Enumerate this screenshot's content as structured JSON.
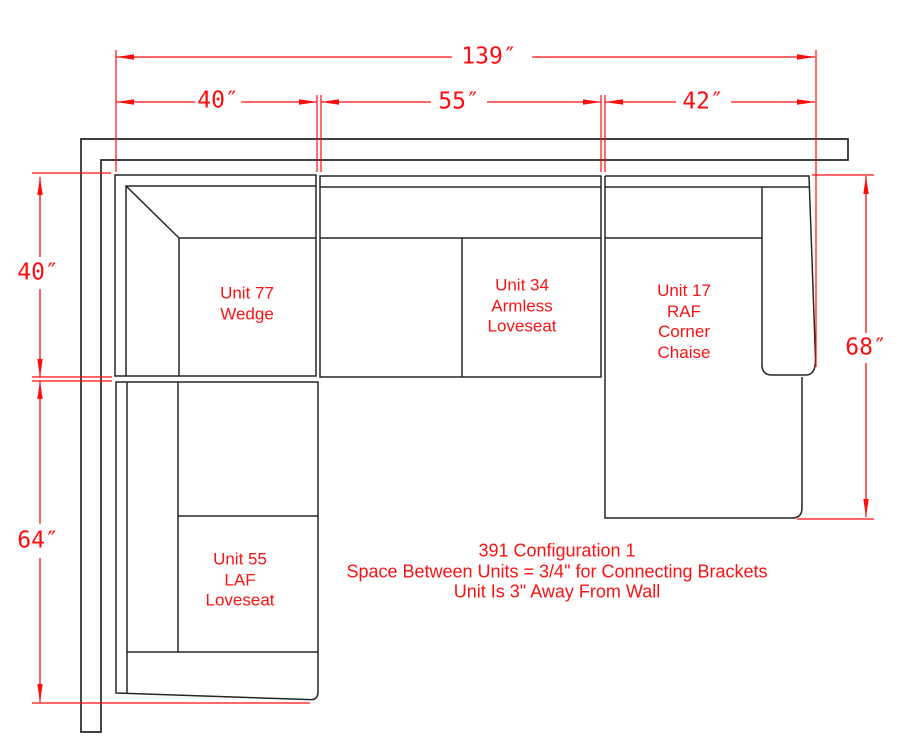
{
  "drawing": {
    "notes": {
      "line1": "391 Configuration 1",
      "line2": "Space Between Units = 3/4\" for Connecting Brackets",
      "line3": "Unit Is 3\" Away From Wall"
    },
    "dimensions": {
      "total_width": "139″",
      "wedge_width": "40″",
      "armless_width": "55″",
      "chaise_width": "42″",
      "wedge_depth": "40″",
      "laf_length": "64″",
      "chaise_depth": "68″"
    },
    "units": {
      "wedge": {
        "line1": "Unit 77",
        "line2": "Wedge"
      },
      "armless_loveseat": {
        "line1": "Unit 34",
        "line2": "Armless",
        "line3": "Loveseat"
      },
      "raf_corner_chaise": {
        "line1": "Unit 17",
        "line2": "RAF",
        "line3": "Corner",
        "line4": "Chaise"
      },
      "laf_loveseat": {
        "line1": "Unit 55",
        "line2": "LAF",
        "line3": "Loveseat"
      }
    },
    "colors": {
      "dimension_red": "#ff0000",
      "outline_black": "#262626",
      "background": "#ffffff"
    }
  }
}
